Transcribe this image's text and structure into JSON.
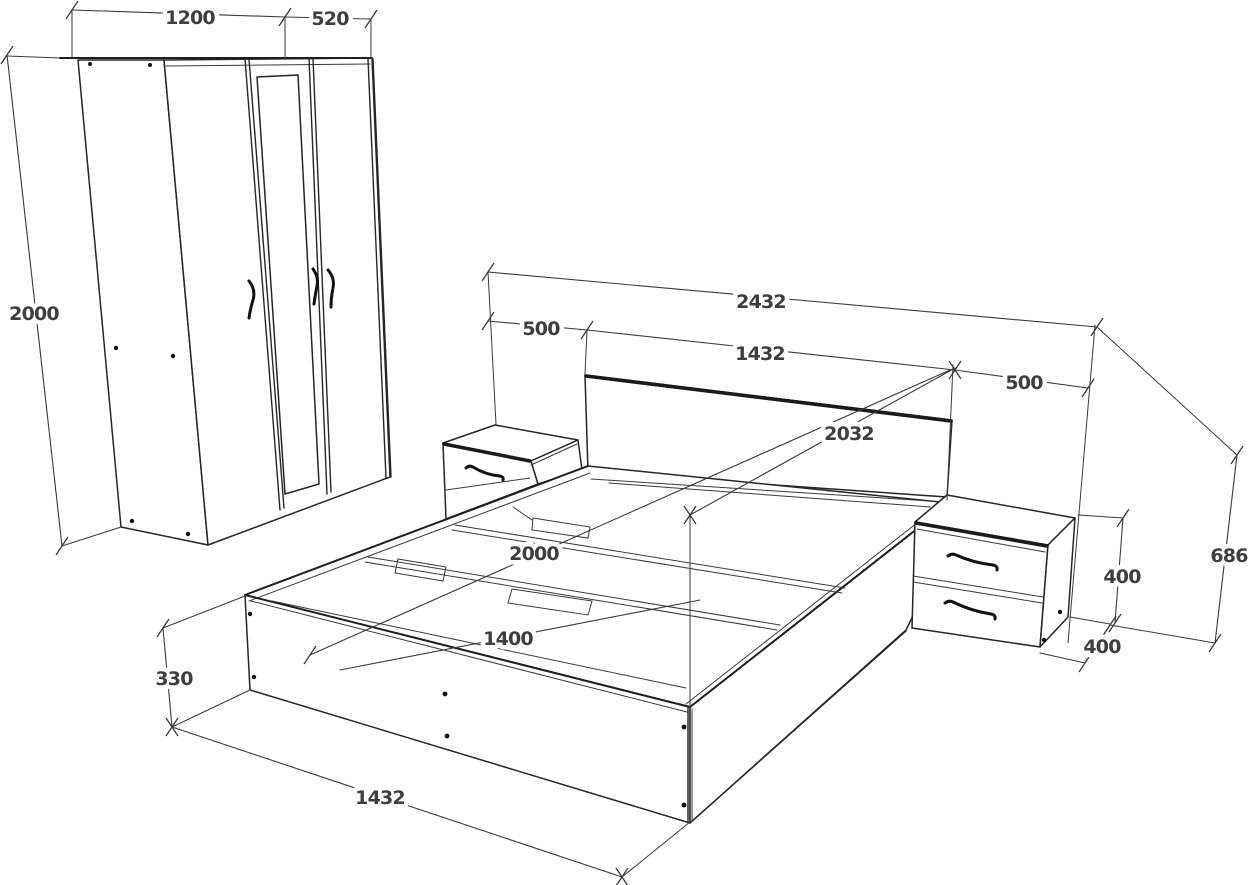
{
  "diagram": {
    "kind": "bedroom furniture set technical line drawing",
    "background_color": "#ffffff",
    "line_color": "#262626",
    "label_color": "#3e3e3e",
    "units_implied": "mm"
  },
  "wardrobe": {
    "name": "three-door wardrobe with mirror",
    "dims": {
      "double_doors_width": "1200",
      "single_door_width": "520",
      "height": "2000"
    }
  },
  "bed": {
    "name": "storage bed with headboard",
    "dims": {
      "total_width_with_nightstands": "2432",
      "frame_width_top": "1432",
      "length_overall": "2032",
      "inner_length": "2000",
      "inner_width": "1400",
      "side_height": "330",
      "frame_width_bottom": "1432"
    }
  },
  "nightstand_left": {
    "name": "left nightstand",
    "dims": {
      "width": "500"
    }
  },
  "nightstand_right": {
    "name": "right nightstand with two drawers",
    "dims": {
      "width": "500",
      "drawer_section_height": "400",
      "depth": "400",
      "total_height": "686"
    }
  }
}
